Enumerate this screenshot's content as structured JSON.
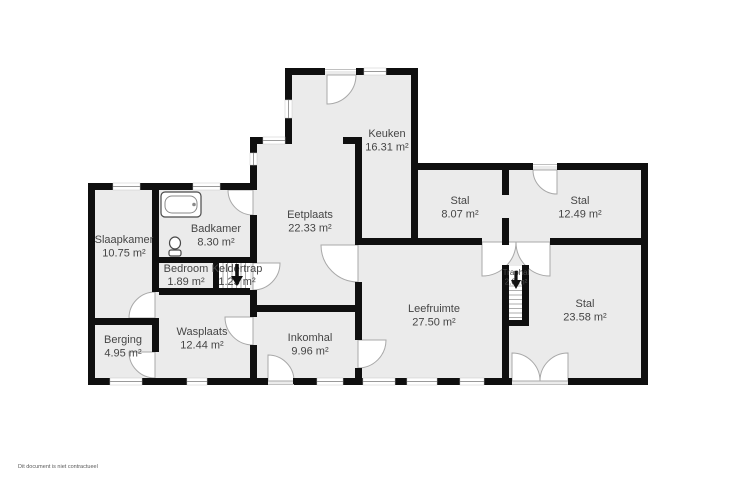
{
  "disclaimer": "Dit document is niet contractueel",
  "floorplan": {
    "colors": {
      "wall": "#0f0f0f",
      "floor": "#ebebeb",
      "label": "#454545",
      "disclaimer": "#5a5a5a"
    },
    "icons": {
      "keldertrap_arrow": "arrow-down",
      "traphal_arrow": "arrow-down"
    },
    "rooms": [
      {
        "name": "Slaapkamer",
        "area": "10.75 m²"
      },
      {
        "name": "Badkamer",
        "area": "8.30 m²"
      },
      {
        "name": "Bedroom",
        "area": "1.89 m²"
      },
      {
        "name": "Keldertrap",
        "area": "1.23 m²"
      },
      {
        "name": "Eetplaats",
        "area": "22.33 m²"
      },
      {
        "name": "Keuken",
        "area": "16.31 m²"
      },
      {
        "name": "Stal",
        "area": "8.07 m²"
      },
      {
        "name": "Stal",
        "area": "12.49 m²"
      },
      {
        "name": "Stal",
        "area": "23.58 m²"
      },
      {
        "name": "Traphal",
        "area": "2.0 m²"
      },
      {
        "name": "Leefruimte",
        "area": "27.50 m²"
      },
      {
        "name": "Inkomhal",
        "area": "9.96 m²"
      },
      {
        "name": "Wasplaats",
        "area": "12.44 m²"
      },
      {
        "name": "Berging",
        "area": "4.95 m²"
      }
    ]
  }
}
